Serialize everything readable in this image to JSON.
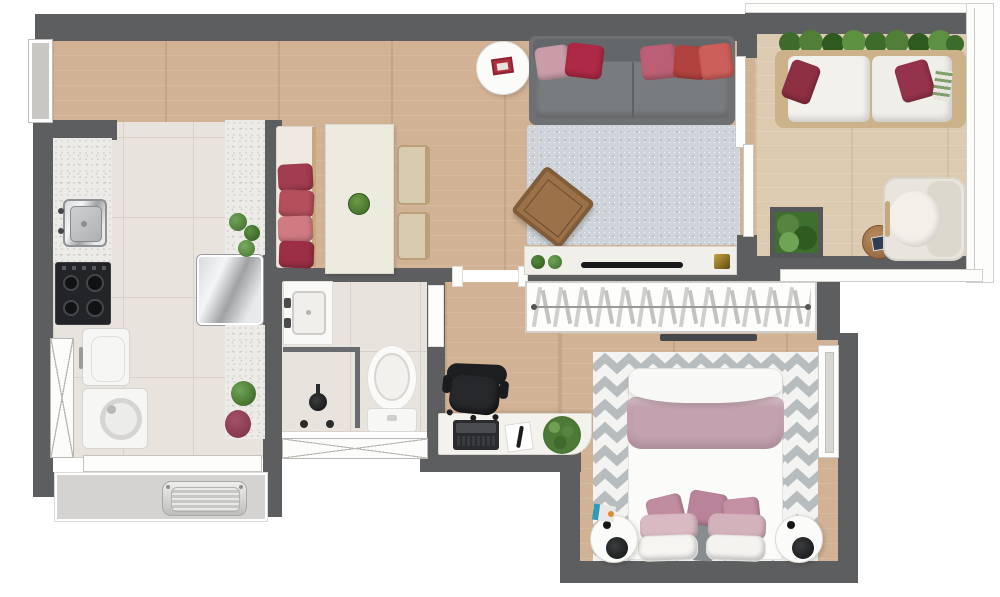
{
  "meta": {
    "title": "Furnished apartment floor plan (top view render)",
    "canvas": {
      "width": 1000,
      "height": 597
    },
    "text_on_image": "none"
  },
  "palette": {
    "wall": "#5d5e60",
    "wood_floor": "#d1b294",
    "balcony_floor": "#ddcbb1",
    "tile_floor": "#e8e3dc",
    "granite": "#ecebe7",
    "living_rug": "#ced4d9",
    "bedroom_rug_stripe": "#b7bcbe",
    "sofa_gray": "#6e7173",
    "accent_red": "#ad2945",
    "accent_pink": "#c99ca7",
    "blanket_mauve": "#c3a1ae",
    "plant_green": "#4d7a37",
    "appliance_black": "#232427"
  },
  "labels": {
    "plan": "Apartment floor plan",
    "entry": "Entry hall",
    "kitchen": "Kitchen",
    "dining": "Dining area",
    "living": "Living room",
    "balcony": "Balcony",
    "bathroom": "Bathroom",
    "hallway": "Hallway / home office",
    "closet": "Built-in wardrobe",
    "bedroom": "Bedroom",
    "service": "Service ledge",
    "counter": "Kitchen counter",
    "sink": "Kitchen sink",
    "stove": "Cooktop",
    "fridge": "Refrigerator",
    "laundry_sink": "Laundry sink",
    "washer": "Washing machine",
    "peninsula": "Granite peninsula",
    "bench": "Dining bench with pillows",
    "table": "Dining table",
    "chair": "Dining chair",
    "sofa": "Gray sofa",
    "side_table": "Round side table",
    "living_rug": "Living room rug",
    "coffee_table": "Coffee table",
    "console": "TV console",
    "tv": "TV",
    "out_sofa": "Outdoor sofa",
    "hedge": "Hedge planter",
    "planter": "Square planter",
    "out_table": "Outdoor side table",
    "armchair": "Armchair",
    "basin": "Washbasin counter",
    "shower": "Shower",
    "toilet": "Toilet",
    "desk": "Desk",
    "office_chair": "Office chair",
    "laptop": "Laptop",
    "notebook": "Notebook and pen",
    "desk_plant": "Desk plant",
    "clothes": "Hanging clothes rail",
    "bed": "Double bed",
    "bedroom_rug": "Chevron rug",
    "nightstand": "Round nightstand",
    "lamp": "Black table lamp",
    "window": "Window",
    "ac": "Condenser / AC unit",
    "parapet": "Balcony parapet",
    "railing": "Balcony railing",
    "sliding_door": "Sliding balcony door"
  },
  "rooms": [
    {
      "id": "entry",
      "label": "Entry hall",
      "floor": "wood"
    },
    {
      "id": "kitchen",
      "label": "Kitchen",
      "floor": "tile",
      "furniture": [
        "granite counter with sink",
        "black 4-burner cooktop",
        "laundry sink",
        "washing machine",
        "stainless refrigerator",
        "granite peninsula with plants"
      ]
    },
    {
      "id": "dining",
      "label": "Dining area",
      "floor": "wood",
      "furniture": [
        "bench with 4 red/pink pillows",
        "white dining table with green bowl",
        "2 beige chairs"
      ]
    },
    {
      "id": "living",
      "label": "Living room",
      "floor": "wood",
      "furniture": [
        "gray sofa with 5 pillows",
        "round side table with red book",
        "speckled gray rug",
        "rotated wood coffee table",
        "TV console with TV"
      ]
    },
    {
      "id": "balcony",
      "label": "Balcony",
      "floor": "wood",
      "furniture": [
        "outdoor sofa with 2 dark-red pillows",
        "hedge planter",
        "square planter",
        "round wood side table",
        "cream armchair"
      ]
    },
    {
      "id": "bathroom",
      "label": "Bathroom",
      "floor": "tile",
      "furniture": [
        "washbasin counter",
        "shower stall",
        "toilet"
      ]
    },
    {
      "id": "hallway",
      "label": "Hallway / home office",
      "floor": "wood",
      "furniture": [
        "white desk",
        "laptop",
        "notebook",
        "plant",
        "black office chair"
      ]
    },
    {
      "id": "closet",
      "label": "Built-in wardrobe",
      "furniture": [
        "rail with hanging clothes",
        "low dark shelf"
      ]
    },
    {
      "id": "bedroom",
      "label": "Bedroom",
      "floor": "wood",
      "furniture": [
        "double bed with mauve blanket and pink pillows",
        "gray chevron rug",
        "2 round nightstands with black lamps",
        "right-wall window"
      ]
    },
    {
      "id": "service",
      "label": "Service ledge",
      "furniture": [
        "metal AC unit"
      ]
    }
  ]
}
